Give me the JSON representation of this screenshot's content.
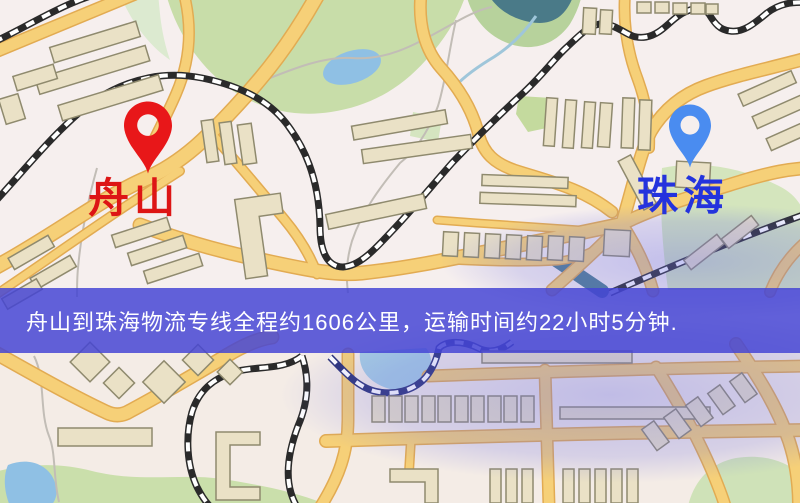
{
  "banner": {
    "text": "舟山到珠海物流专线全程约1606公里，运输时间约22小时5分钟.",
    "background_color": "#4444d4",
    "text_color": "#ffffff"
  },
  "route": {
    "origin": "舟山",
    "destination": "珠海",
    "distance": "约1606公里",
    "duration": "约22小时5分钟"
  },
  "markers": {
    "origin": {
      "label": "舟山",
      "pin_color": "#e81719",
      "label_color": "#dd1515"
    },
    "destination": {
      "label": "珠海",
      "pin_color": "#4a8cf0",
      "label_color": "#2433dd"
    }
  },
  "map": {
    "colors": {
      "background": "#f6efee",
      "road_fill": "#f6d078",
      "road_casing": "#e2ab52",
      "railway": "#2a2a2a",
      "water": "#8fc0e4",
      "river": "#4d7d90",
      "park": "#cbdfac",
      "building_fill": "#eae1c6",
      "building_outline": "#8f8a6e"
    }
  }
}
